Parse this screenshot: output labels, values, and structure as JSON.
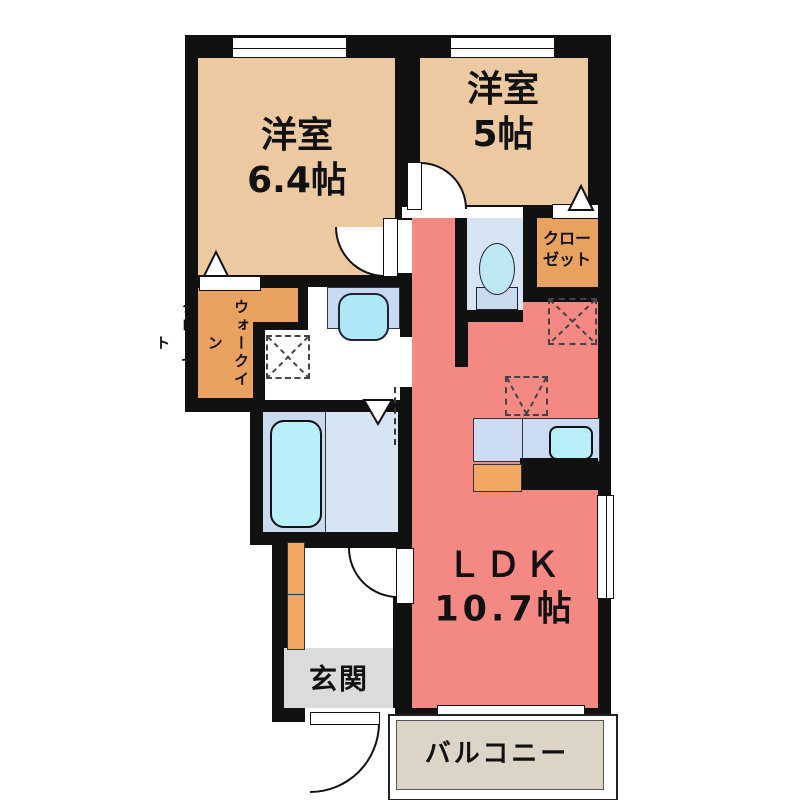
{
  "floorplan": {
    "rooms": {
      "western_room_1": {
        "name": "洋室",
        "size": "6.4帖"
      },
      "western_room_2": {
        "name": "洋室",
        "size": "5帖"
      },
      "ldk": {
        "name": "ＬＤＫ",
        "size": "10.7帖"
      },
      "closet": {
        "line1": "クロー",
        "line2": "ゼット"
      },
      "walk_in_closet": {
        "line1": "ウォークイン",
        "line2": "クローゼット"
      },
      "entrance": {
        "label": "玄関"
      },
      "balcony": {
        "label": "バルコニー"
      }
    },
    "fixtures": [
      "bathtub",
      "toilet",
      "washbasin",
      "kitchen-sink",
      "kitchen-stove",
      "washing-machine-space",
      "refrigerator-space",
      "hanging-cabinet-space",
      "shoe-cabinet"
    ],
    "colors": {
      "wall": "#111111",
      "western_room": "#ECC9A1",
      "closet_orange": "#E8A15E",
      "ldk_salmon": "#F48983",
      "wet_area_blue": "#D6E4F4",
      "fixture_cyan": "#B8EFF8",
      "counter_blue": "#CBDCF2",
      "entrance_gray": "#DBDBDB",
      "balcony_beige": "#DCD5C7"
    }
  }
}
